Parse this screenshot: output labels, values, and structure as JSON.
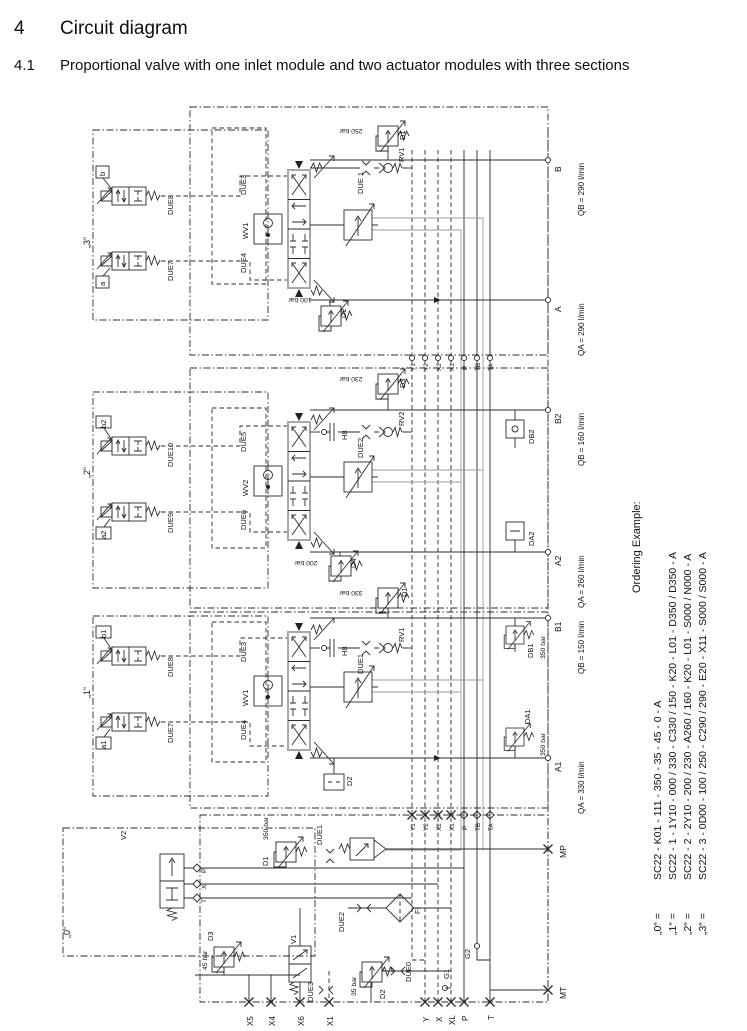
{
  "heading": {
    "num": "4",
    "title": "Circuit diagram",
    "subnum": "4.1",
    "subtitle": "Proportional valve with one inlet module and two actuator modules with three sections"
  },
  "ordering": {
    "title": "Ordering Example:",
    "items": [
      {
        "k": "„0“ =",
        "v": "SC22 - K01 - 111 - 350 - 35 - 45 - 0 - A"
      },
      {
        "k": "„1“ =",
        "v": "SC22 - 1 - 1Y10 - 000 / 330 - C330 / 150 - K20 - L01 - D350 / D350 - A"
      },
      {
        "k": "„2“ =",
        "v": "SC22 - 2 - 2Y10 - 200 / 230 - A260 / 160 - K20 - L01 - S000 / N000 - A"
      },
      {
        "k": "„3“ =",
        "v": "SC22 - 3 - 0D00 - 100 / 250 - C290 / 290 - E20 - X11 - S000 / S000 - A"
      }
    ]
  },
  "s3": {
    "label": "„3“",
    "pilot_b": "b",
    "pilot_b_valve": "DUE8",
    "pilot_a": "a",
    "pilot_a_valve": "DUE7",
    "spool_top": "DUE3",
    "shuttle": "WV1",
    "spool_bot": "DUE4",
    "check": "DUE 1",
    "check_rv": "RV1",
    "relief_top": "D1",
    "relief_top_p": "250 bar",
    "relief_bot": "D2",
    "relief_bot_p": "100 bar",
    "port_b": "B",
    "port_b_q": "QB = 290 l/min",
    "port_a": "A",
    "port_a_q": "QA = 290 l/min"
  },
  "s2": {
    "label": "„2“",
    "pilot_b": "b2",
    "pilot_b_valve": "DUE10",
    "pilot_a": "a2",
    "pilot_a_valve": "DUE9",
    "spool_top": "DUE5",
    "shuttle": "WV2",
    "spool_bot": "DUE6",
    "acc": "H8",
    "check": "DUE2",
    "check_rv": "RV2",
    "relief_top": "D3",
    "relief_top_p": "230 bar",
    "relief_bot": "D4",
    "relief_bot_p": "200 bar",
    "db": "DB2",
    "da": "DA2",
    "port_b": "B2",
    "port_b_q": "QB = 160 l/min",
    "port_a": "A2",
    "port_a_q": "QA = 260 l/min"
  },
  "s1": {
    "label": "„1“",
    "pilot_b": "b1",
    "pilot_b_valve": "DUE8",
    "pilot_a": "a1",
    "pilot_a_valve": "DUE7",
    "spool_top": "DUE3",
    "shuttle": "WV1",
    "spool_bot": "DUE4",
    "acc": "H8",
    "check": "DUE1",
    "check_rv": "RV1",
    "relief_top": "D1",
    "relief_top_p": "330 bar",
    "relief_bot": "D2",
    "db": "DB1",
    "db_p": "350 bar",
    "da": "DA1",
    "da_p": "350 bar",
    "port_b": "B1",
    "port_b_q": "QB = 150 l/min",
    "port_a": "A1",
    "port_a_q": "QA = 330 l/min"
  },
  "s0": {
    "label": "„0“",
    "v2": "V2",
    "p": "P",
    "x": "X",
    "t": "T",
    "relief": "D1",
    "relief_p": "350 bar",
    "due1": "DUE1",
    "d3": "D3",
    "d3_p": "45 bar",
    "v1": "V1",
    "due3": "DUE3",
    "due2": "DUE2",
    "filter": "FI",
    "due0": "DUE0",
    "d2": "D2",
    "d2_p": "35 bar",
    "g1": "G1",
    "g2": "G2",
    "port_mp": "MP",
    "port_mt": "MT"
  },
  "bottom_ports": {
    "x5": "X5",
    "x4": "X4",
    "x6": "X6",
    "x1": "X1",
    "y": "Y",
    "x": "X",
    "xl": "XL",
    "p": "P",
    "t": "T"
  },
  "junction": {
    "y1": "Y1",
    "y2": "Y2",
    "x2": "X2",
    "x1": "X1",
    "p": "P",
    "tb": "TB",
    "ta": "TA"
  }
}
